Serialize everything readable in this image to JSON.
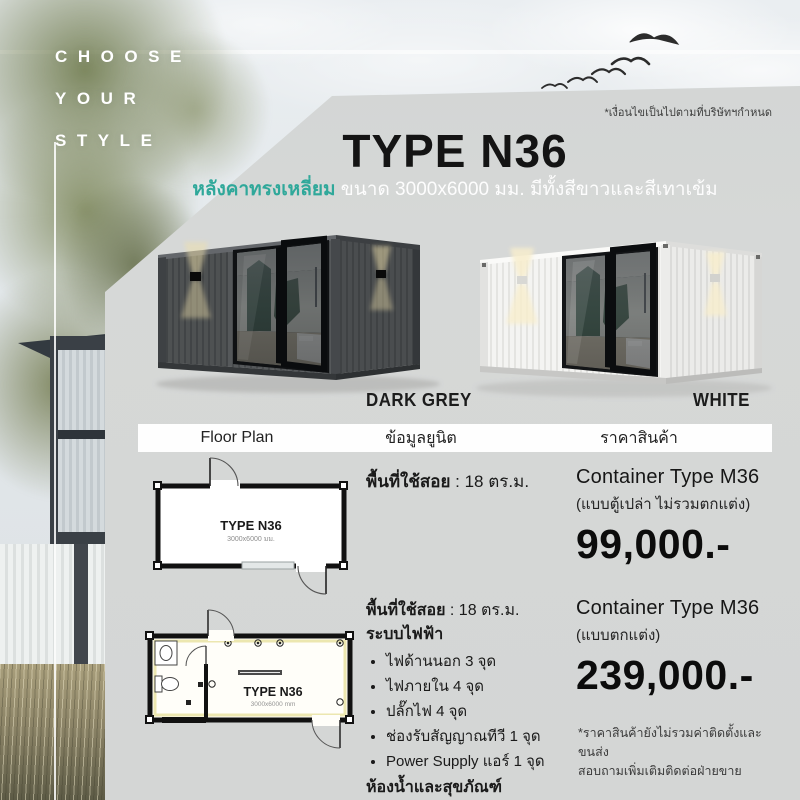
{
  "brand_tagline": {
    "line1": "CHOOSE",
    "line2": "YOUR",
    "line3": "STYLE"
  },
  "top_note": "*เงื่อนไขเป็นไปตามที่บริษัทฯกำหนด",
  "header": {
    "title": "TYPE N36",
    "subtitle_highlight": "หลังคาทรงเหลี่ยม",
    "subtitle_rest": " ขนาด 3000x6000 มม. มีทั้งสีขาวและสีเทาเข้ม"
  },
  "variants": {
    "dark": {
      "label": "DARK GREY"
    },
    "white": {
      "label": "WHITE"
    }
  },
  "table": {
    "col_floor_plan": "Floor Plan",
    "col_unit_info": "ข้อมูลยูนิต",
    "col_price": "ราคาสินค้า"
  },
  "rows": [
    {
      "plan": {
        "name": "TYPE N36",
        "dims": "3000x6000 มม."
      },
      "info": {
        "area_label": "พื้นที่ใช้สอย",
        "area_value": " : 18 ตร.ม."
      },
      "price": {
        "product": "Container Type M36",
        "variant_note": "(แบบตู้เปล่า ไม่รวมตกแต่ง)",
        "amount": "99,000.-"
      }
    },
    {
      "plan": {
        "name": "TYPE N36",
        "dims": "3000x6000 mm"
      },
      "info": {
        "area_label": "พื้นที่ใช้สอย",
        "area_value": " : 18 ตร.ม.",
        "electric_header": "ระบบไฟฟ้า",
        "bullets": [
          "ไฟด้านนอก  3 จุด",
          "ไฟภายใน 4 จุด",
          "ปลั๊กไฟ 4  จุด",
          "ช่องรับสัญญาณทีวี 1 จุด",
          "Power Supply แอร์ 1 จุด"
        ],
        "bathroom_note": "ห้องน้ำและสุขภัณฑ์",
        "furniture_note": "**ไม่รวมเฟอร์นิเจอร์"
      },
      "price": {
        "product": "Container Type M36",
        "variant_note": "(แบบตกแต่ง)",
        "amount": "239,000.-"
      }
    }
  ],
  "footer_note": {
    "line1": "*ราคาสินค้ายังไม่รวมค่าติดตั้งและขนส่ง",
    "line2": "สอบถามเพิ่มเติมติดต่อฝ่ายขาย"
  },
  "colors": {
    "accent_teal": "#2fa89a",
    "panel_gray": "#d5d7d6",
    "price_black": "#0c0c0c"
  }
}
